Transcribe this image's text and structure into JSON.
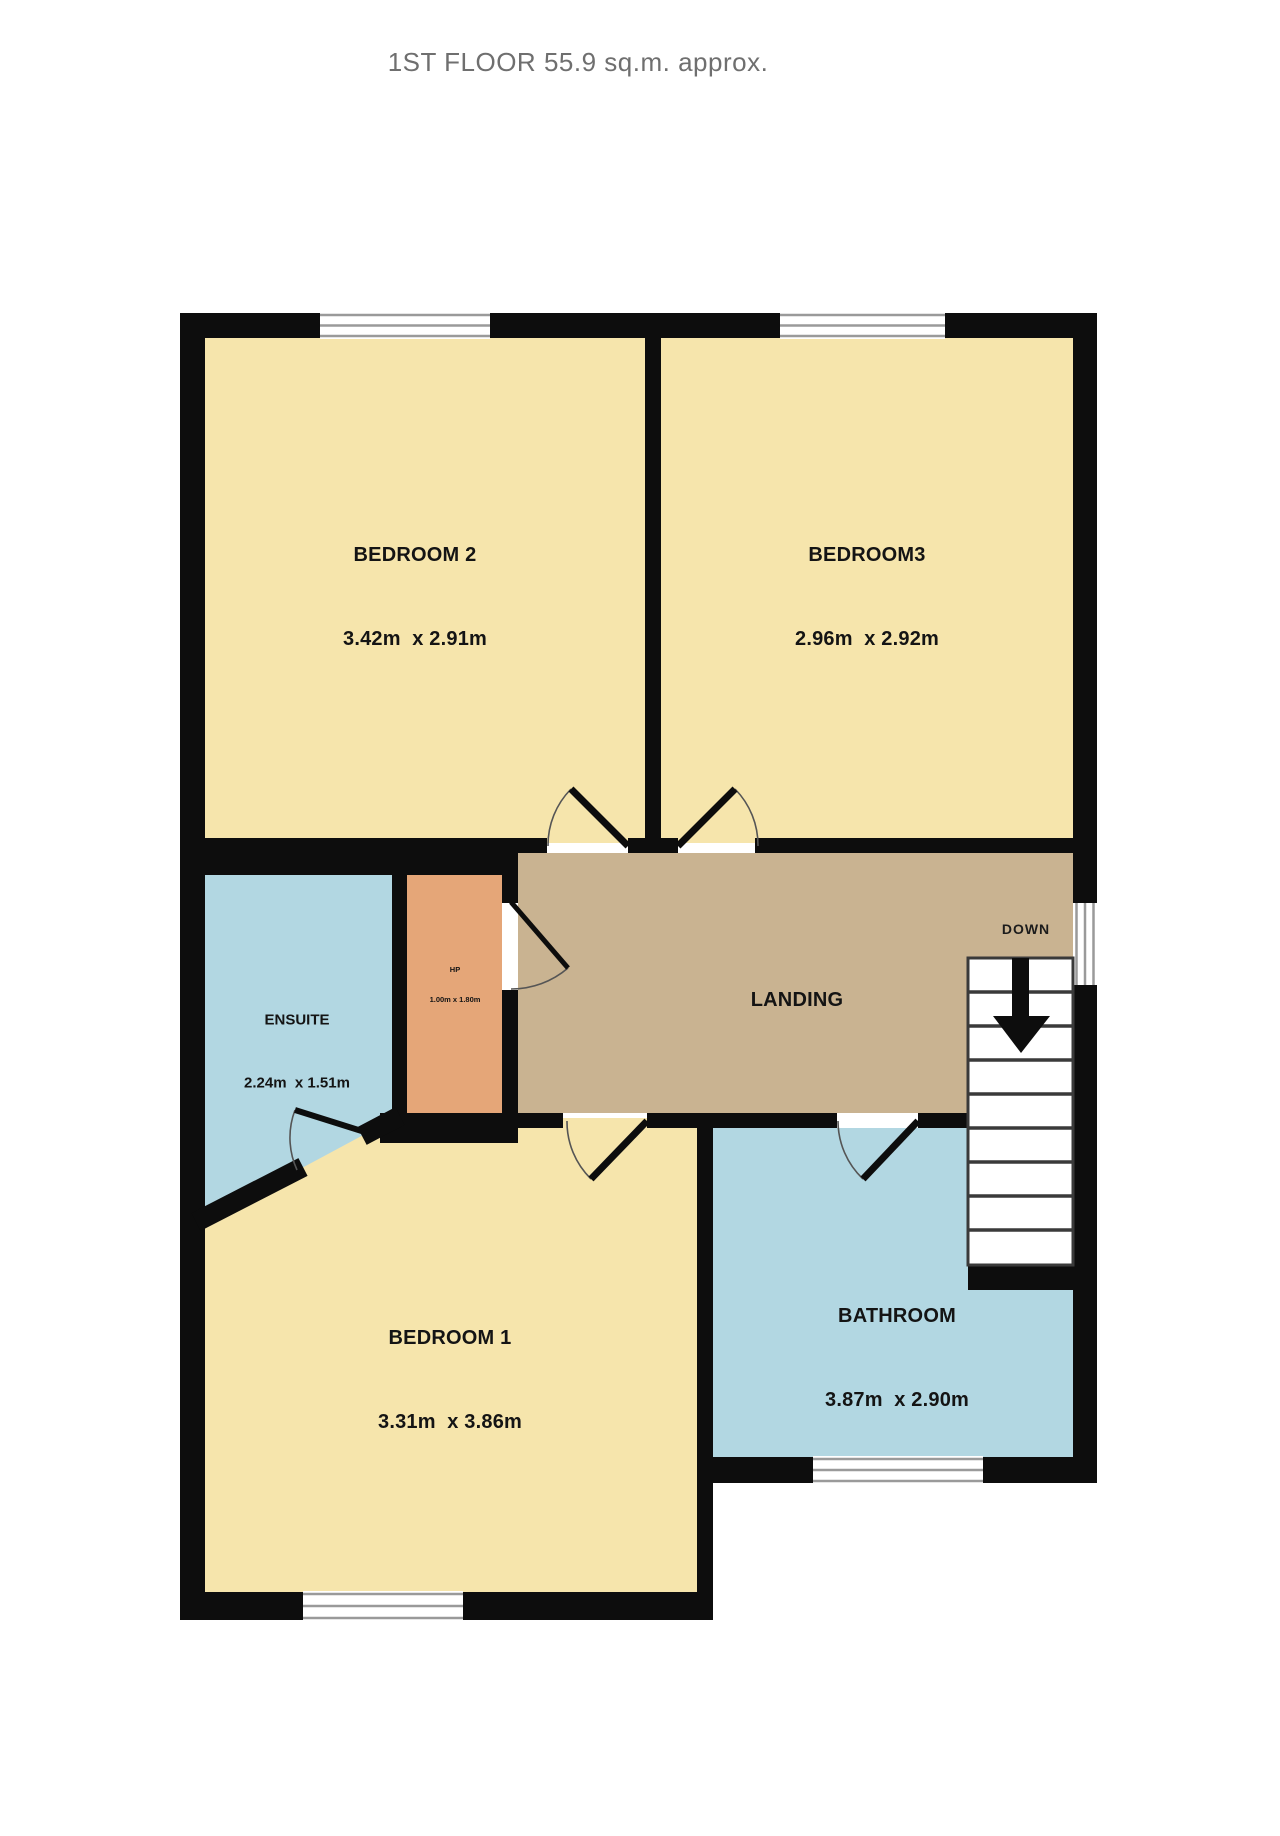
{
  "title": {
    "line1": "1ST FLOOR",
    "line2": "55.9 sq.m. approx."
  },
  "rooms": {
    "bedroom2": {
      "name": "BEDROOM 2",
      "dims": "3.42m  x 2.91m"
    },
    "bedroom3": {
      "name": "BEDROOM3",
      "dims": "2.96m  x 2.92m"
    },
    "ensuite": {
      "name": "ENSUITE",
      "dims": "2.24m  x 1.51m"
    },
    "hp": {
      "name": "HP",
      "dims": "1.00m x 1.80m"
    },
    "landing": {
      "name": "LANDING"
    },
    "bedroom1": {
      "name": "BEDROOM 1",
      "dims": "3.31m  x 3.86m"
    },
    "bathroom": {
      "name": "BATHROOM",
      "dims": "3.87m  x 2.90m"
    },
    "stairs": {
      "label": "DOWN"
    }
  },
  "colors": {
    "bedroom_fill": "#f6e5ac",
    "landing_fill": "#c9b391",
    "wet_room_fill": "#b2d7e2",
    "closet_fill": "#e5a678",
    "wall": "#0d0d0d",
    "window_line": "#9a9a9a",
    "stair_line": "#3a3a3a",
    "door_arc": "#555555"
  }
}
